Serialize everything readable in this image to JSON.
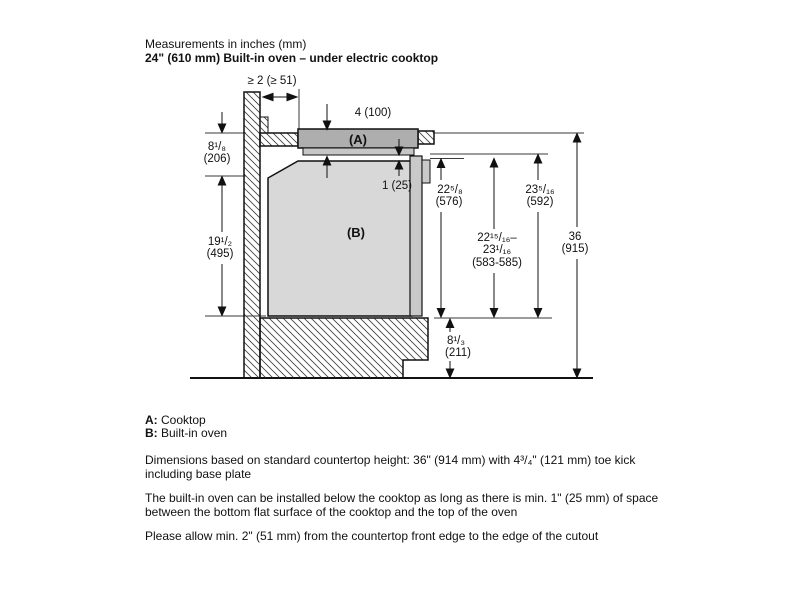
{
  "header": {
    "line1": "Measurements in inches (mm)",
    "line2": "24\" (610 mm) Built-in oven – under electric cooktop"
  },
  "diagram": {
    "label_a": "(A)",
    "label_b": "(B)",
    "dims": {
      "wall_clearance": "≥ 2 (≥ 51)",
      "cooktop_depth": "4 (100)",
      "gap": "1 (25)",
      "counter_to_oven_in": "8¹/₈",
      "counter_to_oven_mm": "(206)",
      "oven_height_in": "19¹/₂",
      "oven_height_mm": "(495)",
      "niche_576_in": "22⁵/₈",
      "niche_576_mm": "(576)",
      "niche_583_in1": "22¹⁵/₁₆–",
      "niche_583_in2": "23¹/₁₆",
      "niche_583_mm": "(583-585)",
      "niche_592_in": "23⁵/₁₆",
      "niche_592_mm": "(592)",
      "total_in": "36",
      "total_mm": "(915)",
      "base_in": "8¹/₃",
      "base_mm": "(211)"
    }
  },
  "legend": {
    "a_key": "A:",
    "a_text": " Cooktop",
    "b_key": "B:",
    "b_text": " Built-in oven"
  },
  "notes": {
    "note1": "Dimensions based on standard countertop height: 36\" (914 mm) with 4³/₄\" (121 mm) toe kick including base plate",
    "note2": "The built-in oven can be installed below the cooktop as long as there is min. 1\" (25 mm) of space between the bottom flat surface of the cooktop and the top of the oven",
    "note3": "Please allow min. 2\" (51 mm) from the countertop front edge to the edge of the cutout"
  }
}
